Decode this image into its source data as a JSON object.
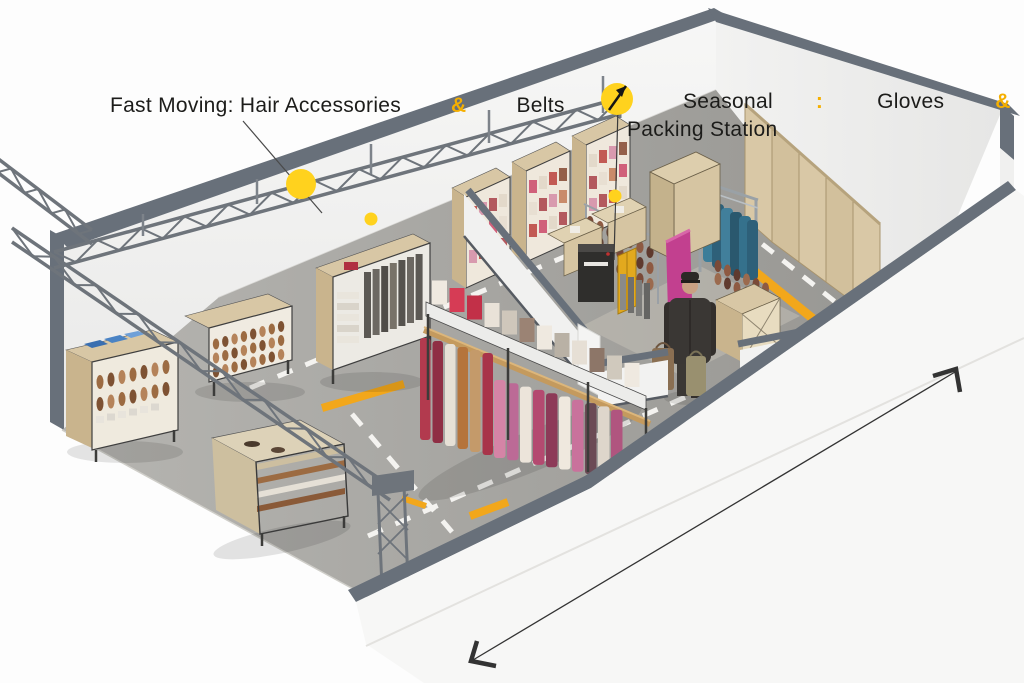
{
  "annotations": {
    "fast_moving": {
      "prefix": "Fast Moving: Hair Accessories",
      "amp": "&",
      "suffix": "Belts"
    },
    "seasonal": {
      "label": "Seasonal",
      "colon": ":",
      "item1": "Gloves",
      "amp": "&",
      "item2": "Scarves",
      "line2": "Packing Station"
    }
  },
  "colors": {
    "accent": "#F5AF00",
    "marker_dot": "#FFD21E",
    "floor_stripe": "#F2A71B",
    "dash_white": "#F4F3F0",
    "wall_cap": "#68707A",
    "wood_panel": "#D7C6A3",
    "truss_steel": "#6E747B",
    "arrow": "#333333",
    "text": "#1C1C1A"
  }
}
